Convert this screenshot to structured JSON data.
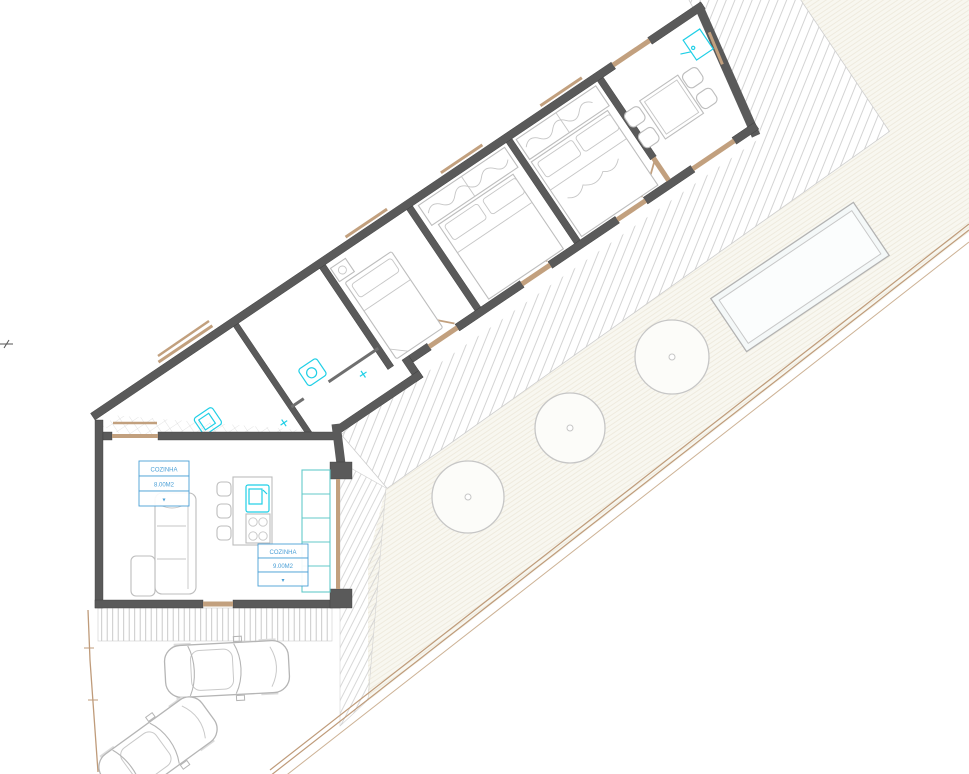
{
  "plan": {
    "type": "architectural-floor-plan",
    "room_labels": [
      {
        "name": "COZINHA",
        "area": "8.00M2",
        "symbol": "▾"
      },
      {
        "name": "COZINHA",
        "area": "9.00M2",
        "symbol": "▾"
      }
    ],
    "rooms": [
      "kitchen-living",
      "bathroom",
      "bedroom-single",
      "bedroom-double",
      "bedroom-master",
      "dining"
    ],
    "site": {
      "trees": 3,
      "cars": 2,
      "pool": true,
      "deck": true
    },
    "colors": {
      "wall": "#5a5a5a",
      "wood_trim": "#c2a07e",
      "fixture_cyan": "#1fcfe6",
      "label_blue": "#4a9fd6",
      "furniture_gray": "#bdbdbd",
      "deck_hatch": "#c9c9c9",
      "yard_hatch": "#e3dcc9",
      "boundary_tan": "#bf9b7a",
      "pool_fill": "#f4f8f8"
    }
  }
}
